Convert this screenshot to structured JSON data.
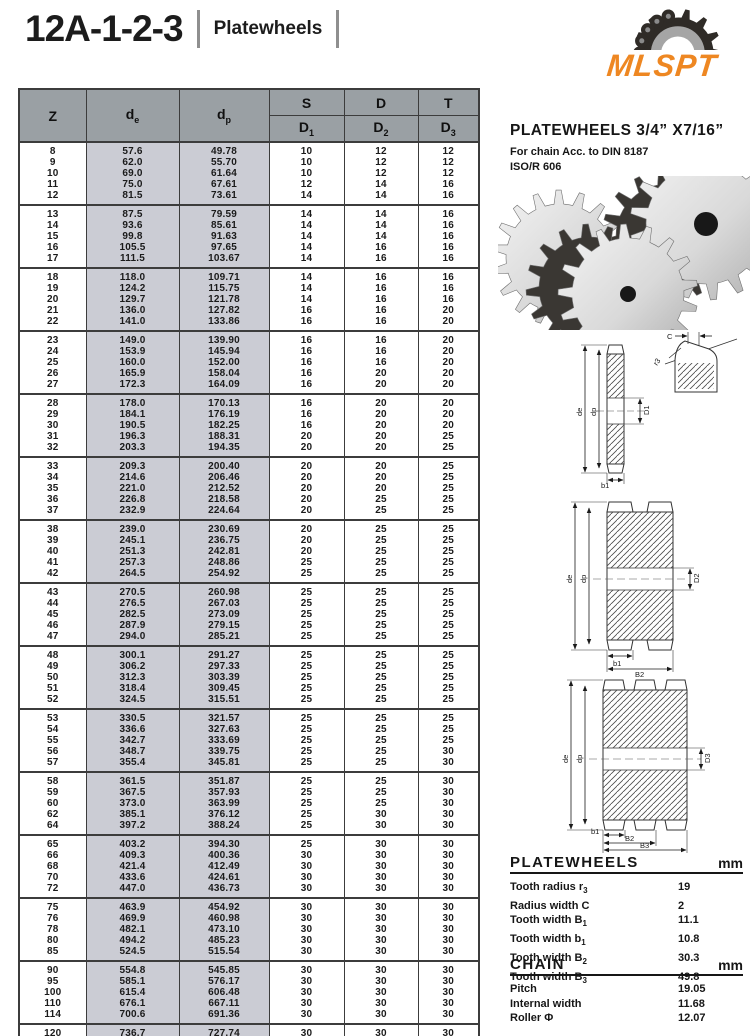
{
  "page": {
    "title": "12A-1-2-3",
    "subtitle": "Platewheels",
    "logo_text": "MLSPT",
    "logo_color": "#EE8722"
  },
  "main_table": {
    "header": {
      "z": "Z",
      "de_base": "d",
      "de_sub": "e",
      "dp_base": "d",
      "dp_sub": "p",
      "s": "S",
      "d": "D",
      "t": "T",
      "d1_base": "D",
      "d1_sub": "1",
      "d2_base": "D",
      "d2_sub": "2",
      "d3_base": "D",
      "d3_sub": "3"
    },
    "groups": [
      [
        [
          "8",
          "57.6",
          "49.78",
          "10",
          "12",
          "12"
        ],
        [
          "9",
          "62.0",
          "55.70",
          "10",
          "12",
          "12"
        ],
        [
          "10",
          "69.0",
          "61.64",
          "10",
          "12",
          "12"
        ],
        [
          "11",
          "75.0",
          "67.61",
          "12",
          "14",
          "16"
        ],
        [
          "12",
          "81.5",
          "73.61",
          "14",
          "14",
          "16"
        ]
      ],
      [
        [
          "13",
          "87.5",
          "79.59",
          "14",
          "14",
          "16"
        ],
        [
          "14",
          "93.6",
          "85.61",
          "14",
          "14",
          "16"
        ],
        [
          "15",
          "99.8",
          "91.63",
          "14",
          "14",
          "16"
        ],
        [
          "16",
          "105.5",
          "97.65",
          "14",
          "16",
          "16"
        ],
        [
          "17",
          "111.5",
          "103.67",
          "14",
          "16",
          "16"
        ]
      ],
      [
        [
          "18",
          "118.0",
          "109.71",
          "14",
          "16",
          "16"
        ],
        [
          "19",
          "124.2",
          "115.75",
          "14",
          "16",
          "16"
        ],
        [
          "20",
          "129.7",
          "121.78",
          "14",
          "16",
          "16"
        ],
        [
          "21",
          "136.0",
          "127.82",
          "16",
          "16",
          "20"
        ],
        [
          "22",
          "141.0",
          "133.86",
          "16",
          "16",
          "20"
        ]
      ],
      [
        [
          "23",
          "149.0",
          "139.90",
          "16",
          "16",
          "20"
        ],
        [
          "24",
          "153.9",
          "145.94",
          "16",
          "16",
          "20"
        ],
        [
          "25",
          "160.0",
          "152.00",
          "16",
          "16",
          "20"
        ],
        [
          "26",
          "165.9",
          "158.04",
          "16",
          "20",
          "20"
        ],
        [
          "27",
          "172.3",
          "164.09",
          "16",
          "20",
          "20"
        ]
      ],
      [
        [
          "28",
          "178.0",
          "170.13",
          "16",
          "20",
          "20"
        ],
        [
          "29",
          "184.1",
          "176.19",
          "16",
          "20",
          "20"
        ],
        [
          "30",
          "190.5",
          "182.25",
          "16",
          "20",
          "20"
        ],
        [
          "31",
          "196.3",
          "188.31",
          "20",
          "20",
          "25"
        ],
        [
          "32",
          "203.3",
          "194.35",
          "20",
          "20",
          "25"
        ]
      ],
      [
        [
          "33",
          "209.3",
          "200.40",
          "20",
          "20",
          "25"
        ],
        [
          "34",
          "214.6",
          "206.46",
          "20",
          "20",
          "25"
        ],
        [
          "35",
          "221.0",
          "212.52",
          "20",
          "20",
          "25"
        ],
        [
          "36",
          "226.8",
          "218.58",
          "20",
          "25",
          "25"
        ],
        [
          "37",
          "232.9",
          "224.64",
          "20",
          "25",
          "25"
        ]
      ],
      [
        [
          "38",
          "239.0",
          "230.69",
          "20",
          "25",
          "25"
        ],
        [
          "39",
          "245.1",
          "236.75",
          "20",
          "25",
          "25"
        ],
        [
          "40",
          "251.3",
          "242.81",
          "20",
          "25",
          "25"
        ],
        [
          "41",
          "257.3",
          "248.86",
          "25",
          "25",
          "25"
        ],
        [
          "42",
          "264.5",
          "254.92",
          "25",
          "25",
          "25"
        ]
      ],
      [
        [
          "43",
          "270.5",
          "260.98",
          "25",
          "25",
          "25"
        ],
        [
          "44",
          "276.5",
          "267.03",
          "25",
          "25",
          "25"
        ],
        [
          "45",
          "282.5",
          "273.09",
          "25",
          "25",
          "25"
        ],
        [
          "46",
          "287.9",
          "279.15",
          "25",
          "25",
          "25"
        ],
        [
          "47",
          "294.0",
          "285.21",
          "25",
          "25",
          "25"
        ]
      ],
      [
        [
          "48",
          "300.1",
          "291.27",
          "25",
          "25",
          "25"
        ],
        [
          "49",
          "306.2",
          "297.33",
          "25",
          "25",
          "25"
        ],
        [
          "50",
          "312.3",
          "303.39",
          "25",
          "25",
          "25"
        ],
        [
          "51",
          "318.4",
          "309.45",
          "25",
          "25",
          "25"
        ],
        [
          "52",
          "324.5",
          "315.51",
          "25",
          "25",
          "25"
        ]
      ],
      [
        [
          "53",
          "330.5",
          "321.57",
          "25",
          "25",
          "25"
        ],
        [
          "54",
          "336.6",
          "327.63",
          "25",
          "25",
          "25"
        ],
        [
          "55",
          "342.7",
          "333.69",
          "25",
          "25",
          "25"
        ],
        [
          "56",
          "348.7",
          "339.75",
          "25",
          "25",
          "30"
        ],
        [
          "57",
          "355.4",
          "345.81",
          "25",
          "25",
          "30"
        ]
      ],
      [
        [
          "58",
          "361.5",
          "351.87",
          "25",
          "25",
          "30"
        ],
        [
          "59",
          "367.5",
          "357.93",
          "25",
          "25",
          "30"
        ],
        [
          "60",
          "373.0",
          "363.99",
          "25",
          "25",
          "30"
        ],
        [
          "62",
          "385.1",
          "376.12",
          "25",
          "30",
          "30"
        ],
        [
          "64",
          "397.2",
          "388.24",
          "25",
          "30",
          "30"
        ]
      ],
      [
        [
          "65",
          "403.2",
          "394.30",
          "25",
          "30",
          "30"
        ],
        [
          "66",
          "409.3",
          "400.36",
          "30",
          "30",
          "30"
        ],
        [
          "68",
          "421.4",
          "412.49",
          "30",
          "30",
          "30"
        ],
        [
          "70",
          "433.6",
          "424.61",
          "30",
          "30",
          "30"
        ],
        [
          "72",
          "447.0",
          "436.73",
          "30",
          "30",
          "30"
        ]
      ],
      [
        [
          "75",
          "463.9",
          "454.92",
          "30",
          "30",
          "30"
        ],
        [
          "76",
          "469.9",
          "460.98",
          "30",
          "30",
          "30"
        ],
        [
          "78",
          "482.1",
          "473.10",
          "30",
          "30",
          "30"
        ],
        [
          "80",
          "494.2",
          "485.23",
          "30",
          "30",
          "30"
        ],
        [
          "85",
          "524.5",
          "515.54",
          "30",
          "30",
          "30"
        ]
      ],
      [
        [
          "90",
          "554.8",
          "545.85",
          "30",
          "30",
          "30"
        ],
        [
          "95",
          "585.1",
          "576.17",
          "30",
          "30",
          "30"
        ],
        [
          "100",
          "615.4",
          "606.48",
          "30",
          "30",
          "30"
        ],
        [
          "110",
          "676.1",
          "667.11",
          "30",
          "30",
          "30"
        ],
        [
          "114",
          "700.6",
          "691.36",
          "30",
          "30",
          "30"
        ]
      ],
      [
        [
          "120",
          "736.7",
          "727.74",
          "30",
          "30",
          "30"
        ],
        [
          "125",
          "767.0",
          "758.06",
          "30",
          "30",
          "30"
        ]
      ]
    ]
  },
  "right_panel": {
    "heading": "PLATEWHEELS 3/4” X7/16”",
    "sub1": "For chain Acc. to DIN 8187",
    "sub2": "ISO/R 606",
    "platewheels_spec": {
      "title": "PLATEWHEELS",
      "unit": "mm",
      "rows": [
        {
          "label": "Tooth radius r",
          "sub": "3",
          "value": "19"
        },
        {
          "label": "Radius width C",
          "sub": "",
          "value": "2"
        },
        {
          "label": "Tooth width B",
          "sub": "1",
          "value": "11.1"
        },
        {
          "label": "Tooth width b",
          "sub": "1",
          "value": "10.8"
        },
        {
          "label": "Tooth width B",
          "sub": "2",
          "value": "30.3"
        },
        {
          "label": "Tooth width B",
          "sub": "3",
          "value": "49.8"
        }
      ]
    },
    "chain_spec": {
      "title": "CHAIN",
      "unit": "mm",
      "rows": [
        {
          "label": "Pitch",
          "sub": "",
          "value": "19.05"
        },
        {
          "label": "Internal width",
          "sub": "",
          "value": "11.68"
        },
        {
          "label": "Roller Φ",
          "sub": "",
          "value": "12.07"
        }
      ]
    }
  },
  "drawings": {
    "single": {
      "outer": "de",
      "pitch": "dp",
      "bore": "D1",
      "width": "b1",
      "c": "C",
      "r": "r3"
    },
    "duplex": {
      "outer": "de",
      "pitch": "dp",
      "bore": "D2",
      "width1": "b1",
      "width2": "B2"
    },
    "triplex": {
      "outer": "de",
      "pitch": "dp",
      "bore": "D3",
      "width1": "b1",
      "width2": "B2",
      "width3": "B3"
    }
  }
}
